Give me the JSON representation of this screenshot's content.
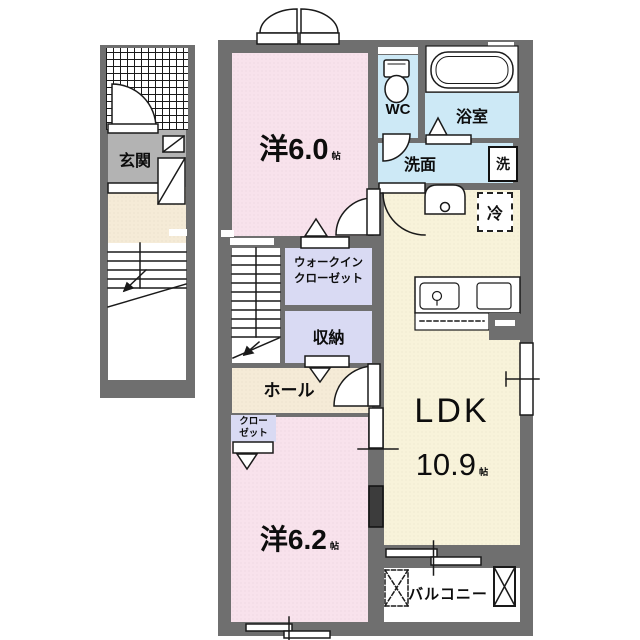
{
  "colors": {
    "wall": "#6f6f6f",
    "room_pink": "#f8e2ec",
    "room_lavender": "#d9daf3",
    "room_blue": "#cde9f6",
    "room_cream": "#f8f3da",
    "hall_cream": "#f5ebd7",
    "genkan_gray": "#b3b3b3",
    "line": "#1a1a1a"
  },
  "rooms": {
    "genkan": {
      "label": "玄関"
    },
    "western1": {
      "name": "洋6.0",
      "unit": "帖",
      "size_jo": 6.0
    },
    "wc": {
      "label": "WC"
    },
    "bathroom": {
      "label": "浴室"
    },
    "washroom": {
      "label": "洗面"
    },
    "washer": {
      "label": "洗"
    },
    "fridge": {
      "label": "冷"
    },
    "wic": {
      "line1": "ウォークイン",
      "line2": "クローゼット"
    },
    "storage": {
      "label": "収納"
    },
    "hall": {
      "label": "ホール"
    },
    "closet": {
      "line1": "クロー",
      "line2": "ゼット"
    },
    "ldk": {
      "name": "LDK",
      "size": "10.9",
      "unit": "帖",
      "size_jo": 10.9
    },
    "western2": {
      "name": "洋6.2",
      "unit": "帖",
      "size_jo": 6.2
    },
    "balcony": {
      "label": "バルコニー"
    }
  }
}
